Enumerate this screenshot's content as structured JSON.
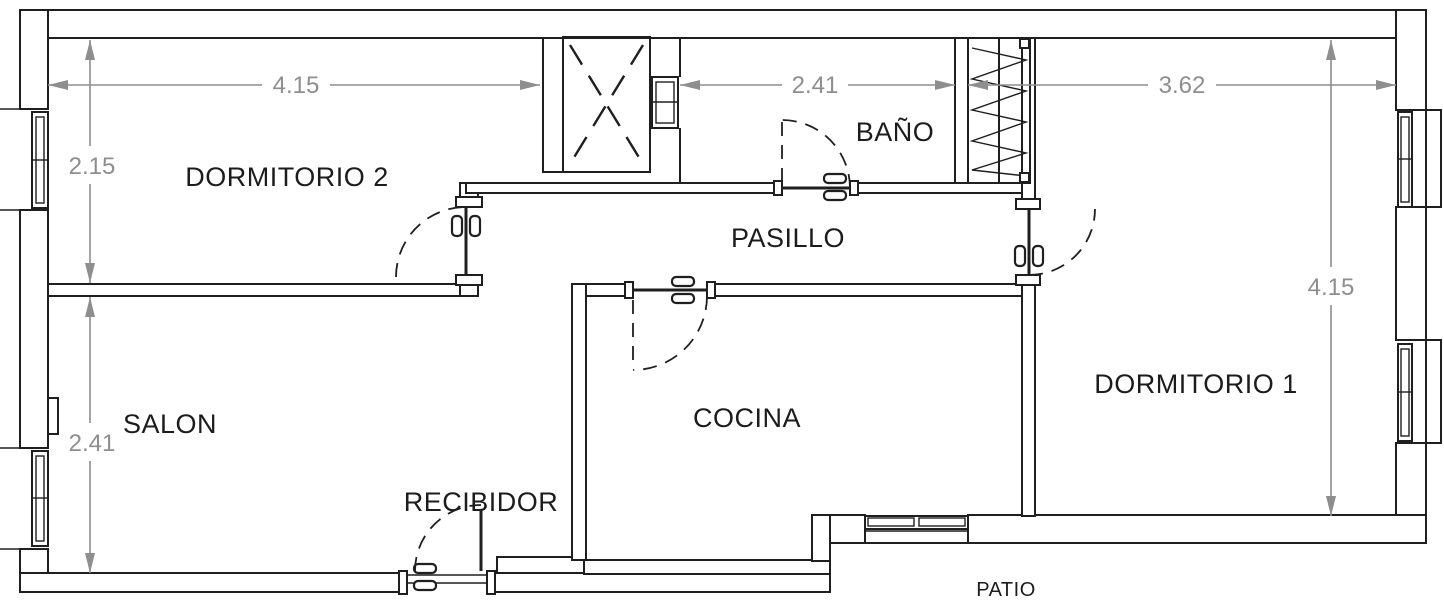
{
  "plan": {
    "title": "apartment-floor-plan",
    "rooms": [
      {
        "id": "dormitorio-2",
        "label": "DORMITORIO 2"
      },
      {
        "id": "bano",
        "label": "BAÑO"
      },
      {
        "id": "pasillo",
        "label": "PASILLO"
      },
      {
        "id": "dormitorio-1",
        "label": "DORMITORIO 1"
      },
      {
        "id": "salon",
        "label": "SALON"
      },
      {
        "id": "recibidor",
        "label": "RECIBIDOR"
      },
      {
        "id": "cocina",
        "label": "COCINA"
      },
      {
        "id": "patio",
        "label": "PATIO"
      }
    ],
    "dimensions": [
      {
        "id": "dormitorio2-width",
        "value": "4.15",
        "orientation": "horizontal"
      },
      {
        "id": "bano-width",
        "value": "2.41",
        "orientation": "horizontal"
      },
      {
        "id": "dormitorio1-width",
        "value": "3.62",
        "orientation": "horizontal"
      },
      {
        "id": "dormitorio2-height",
        "value": "2.15",
        "orientation": "vertical"
      },
      {
        "id": "salon-height",
        "value": "2.41",
        "orientation": "vertical"
      },
      {
        "id": "dormitorio1-height",
        "value": "4.15",
        "orientation": "vertical"
      }
    ],
    "features": [
      "light-shaft",
      "built-in-closet",
      "window-dormitorio2",
      "window-salon",
      "window-dormitorio1-upper",
      "window-dormitorio1-lower",
      "window-cocina",
      "window-bano-shaft",
      "door-dormitorio2",
      "door-bano",
      "door-cocina",
      "door-dormitorio1",
      "door-entrance"
    ],
    "colors": {
      "wall": "#1f1f1f",
      "dimension": "#8e8e8e",
      "background": "#ffffff"
    }
  }
}
